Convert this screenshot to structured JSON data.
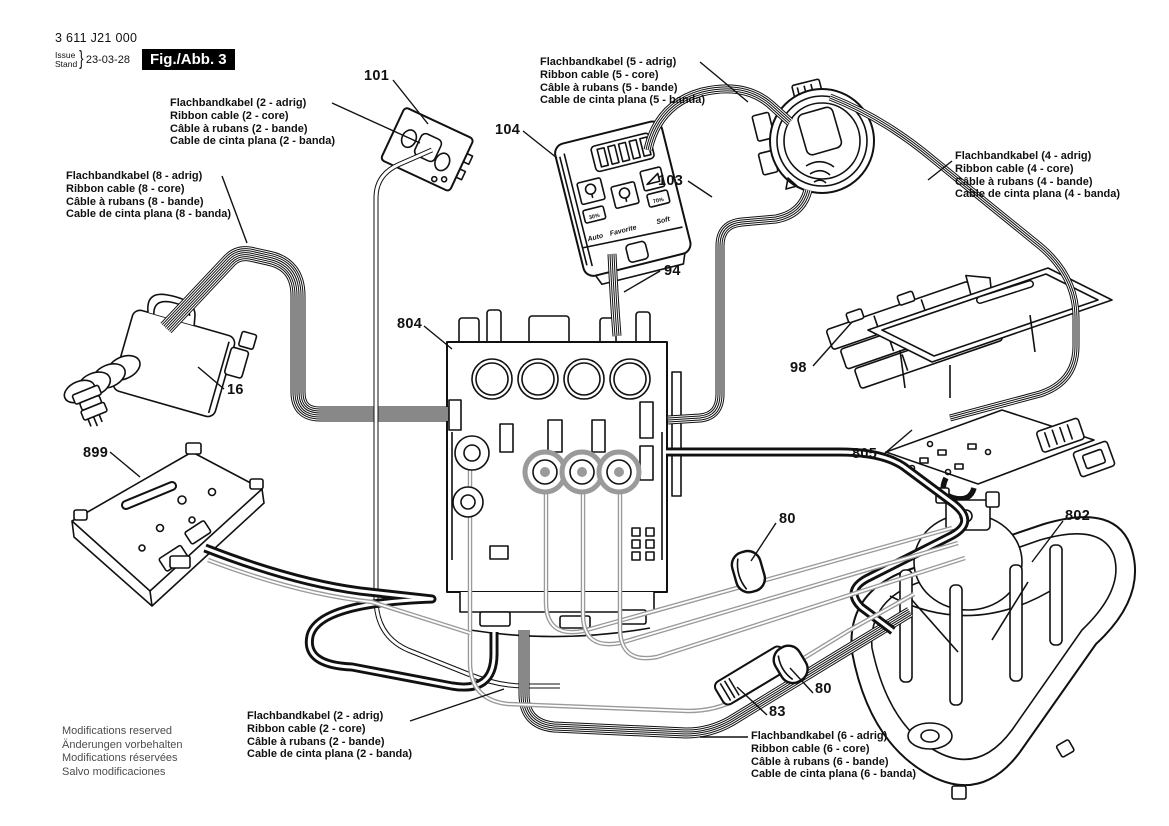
{
  "header": {
    "part_number": "3 611 J21 000",
    "issue_label_top": "Issue",
    "issue_label_bottom": "Stand",
    "issue_date": "23-03-28",
    "figure_label": "Fig./Abb. 3"
  },
  "cable_labels": [
    {
      "name": "ribbon-cable-2-core-top",
      "lines": [
        "Flachbandkabel (2 - adrig)",
        "Ribbon cable (2 - core)",
        "Câble à rubans (2 - bande)",
        "Cable de cinta plana (2 - banda)"
      ]
    },
    {
      "name": "ribbon-cable-5-core",
      "lines": [
        "Flachbandkabel (5 - adrig)",
        "Ribbon cable (5 - core)",
        "Câble à rubans (5 - bande)",
        "Cable de cinta plana (5 - banda)"
      ]
    },
    {
      "name": "ribbon-cable-8-core",
      "lines": [
        "Flachbandkabel (8 - adrig)",
        "Ribbon cable (8 - core)",
        "Câble à rubans (8 - bande)",
        "Cable de cinta plana (8 - banda)"
      ]
    },
    {
      "name": "ribbon-cable-4-core",
      "lines": [
        "Flachbandkabel (4 - adrig)",
        "Ribbon cable (4 - core)",
        "Câble à rubans (4 - bande)",
        "Cable de cinta plana (4 - banda)"
      ]
    },
    {
      "name": "ribbon-cable-2-core-bottom",
      "lines": [
        "Flachbandkabel (2 - adrig)",
        "Ribbon cable (2 - core)",
        "Câble à rubans (2 - bande)",
        "Cable de cinta plana (2 - banda)"
      ]
    },
    {
      "name": "ribbon-cable-6-core",
      "lines": [
        "Flachbandkabel (6 - adrig)",
        "Ribbon cable (6 - core)",
        "Câble à rubans (6 - bande)",
        "Cable de cinta plana (6 - banda)"
      ]
    }
  ],
  "callouts": [
    {
      "number": "101"
    },
    {
      "number": "104"
    },
    {
      "number": "103"
    },
    {
      "number": "94"
    },
    {
      "number": "804"
    },
    {
      "number": "16"
    },
    {
      "number": "899"
    },
    {
      "number": "98"
    },
    {
      "number": "805"
    },
    {
      "number": "80"
    },
    {
      "number": "802"
    },
    {
      "number": "80"
    },
    {
      "number": "83"
    }
  ],
  "display_panel": {
    "buttons": [
      "Auto",
      "Favorite",
      "Soft"
    ],
    "left_level": "30%",
    "right_level": "70%"
  },
  "footer": {
    "lines": [
      "Modifications reserved",
      "Änderungen vorbehalten",
      "Modifications réservées",
      "Salvo modificaciones"
    ]
  },
  "colors": {
    "line": "#111111",
    "cable_gray": "#9a9a9a",
    "background": "#ffffff",
    "figure_box_bg": "#000000",
    "figure_box_text": "#ffffff",
    "footer_text": "#4d4d4d"
  }
}
